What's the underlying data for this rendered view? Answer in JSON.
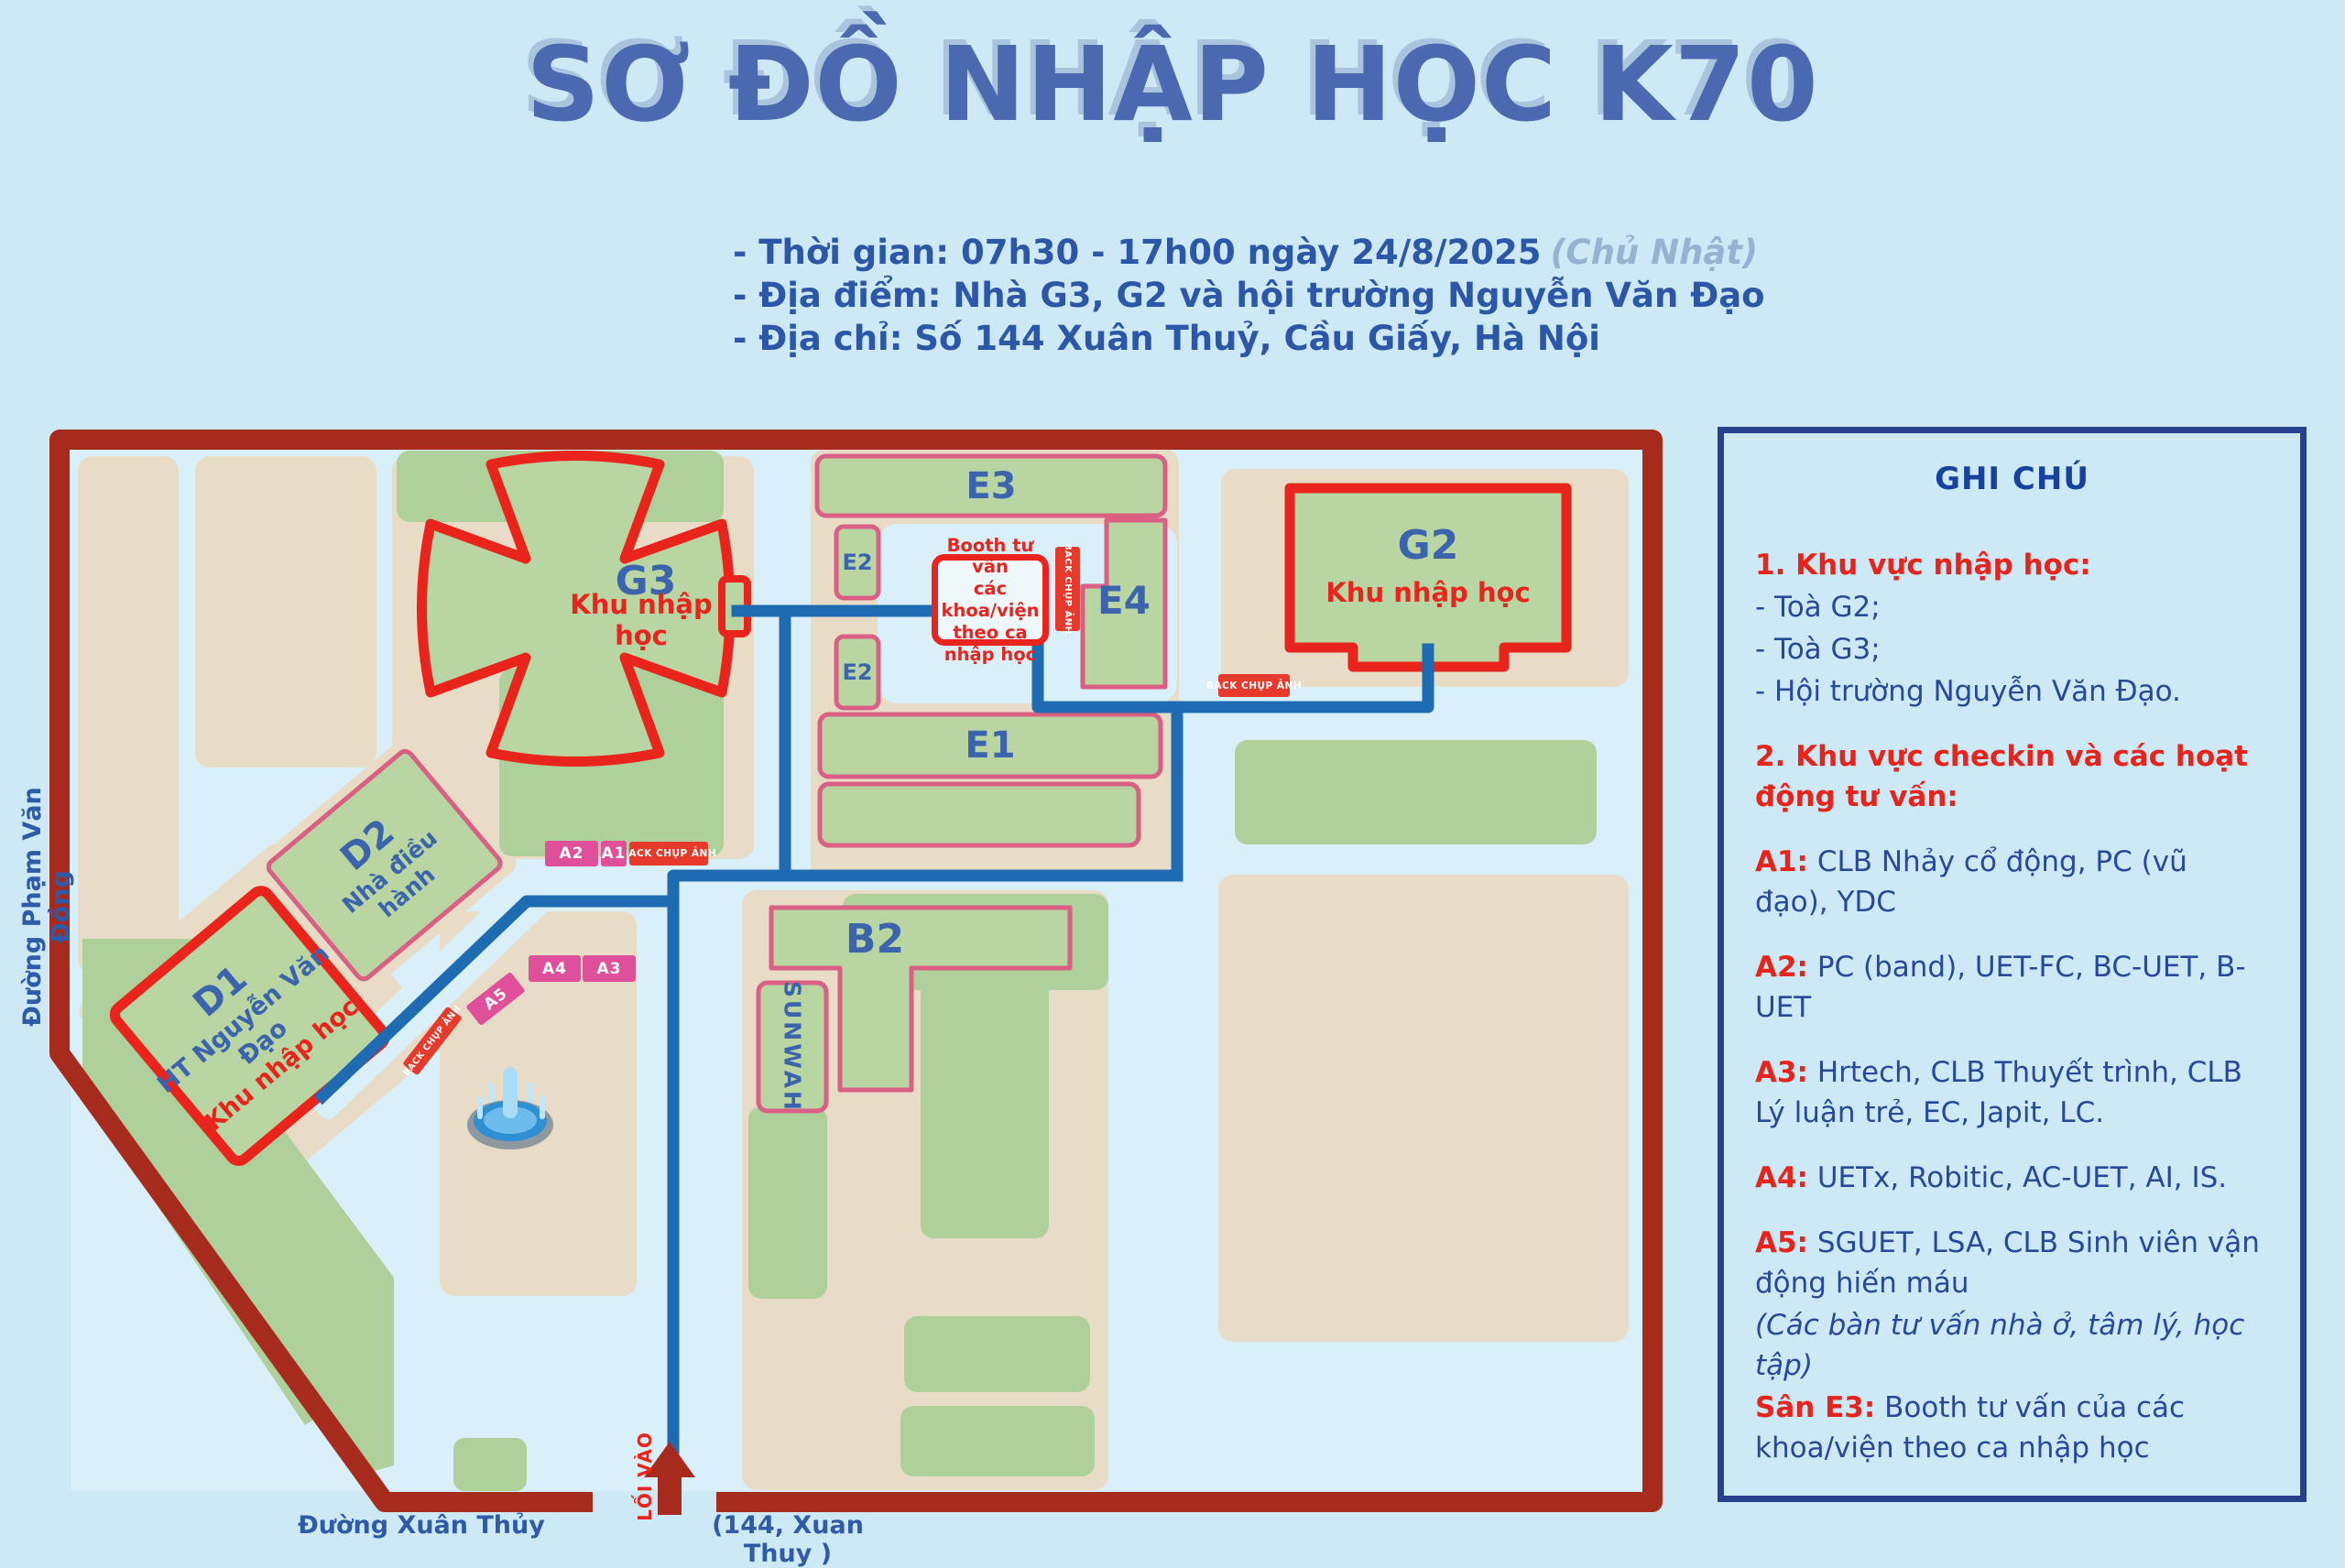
{
  "title": "SƠ ĐỒ NHẬP HỌC K70",
  "info_lines": [
    {
      "main": "- Thời gian: 07h30 - 17h00 ngày 24/8/2025",
      "note": "(Chủ Nhật)"
    },
    {
      "main": "- Địa điểm: Nhà G3, G2 và hội trường Nguyễn Văn Đạo",
      "note": ""
    },
    {
      "main": "- Địa chỉ: Số 144 Xuân Thuỷ, Cầu Giấy, Hà Nội",
      "note": ""
    }
  ],
  "map": {
    "streets": {
      "left": "Đường Phạm Văn Đồng",
      "bottom": "Đường Xuân Thủy",
      "address": "(144, Xuan Thuy )",
      "entrance": "LỐI VÀO"
    },
    "buildings": {
      "g3": {
        "name": "G3",
        "sub": "Khu nhập học"
      },
      "g2": {
        "name": "G2",
        "sub": "Khu nhập học"
      },
      "e3": {
        "name": "E3"
      },
      "e2a": {
        "name": "E2"
      },
      "e2b": {
        "name": "E2"
      },
      "e4": {
        "name": "E4"
      },
      "e1": {
        "name": "E1"
      },
      "b2": {
        "name": "B2"
      },
      "sunwah": {
        "name": "SUNWAH"
      },
      "d2": {
        "name": "D2",
        "sub": "Nhà điều hành"
      },
      "d1": {
        "name": "D1",
        "sub1": "HT Nguyễn Văn Đạo",
        "sub2": "Khu nhập học"
      }
    },
    "booth": {
      "lines": [
        "Booth tư vấn",
        "các khoa/viện",
        "theo ca",
        "nhập học"
      ]
    },
    "badges": {
      "a1": "A1",
      "a2": "A2",
      "a3": "A3",
      "a4": "A4",
      "a5": "A5",
      "back": "BACK CHỤP ẢNH"
    }
  },
  "legend": {
    "title": "GHI CHÚ",
    "section1": {
      "head": "1. Khu vực nhập học:",
      "items": [
        "- Toà G2;",
        "- Toà G3;",
        "- Hội trường Nguyễn Văn Đạo."
      ]
    },
    "section2": {
      "head": "2. Khu vực checkin và các hoạt động tư vấn:"
    },
    "entries": [
      {
        "key": "A1:",
        "text": " CLB Nhảy cổ động, PC (vũ đạo), YDC"
      },
      {
        "key": "A2:",
        "text": " PC (band), UET-FC, BC-UET, B-UET"
      },
      {
        "key": "A3:",
        "text": " Hrtech, CLB Thuyết trình, CLB Lý luận trẻ, EC, Japit, LC."
      },
      {
        "key": "A4:",
        "text": " UETx, Robitic, AC-UET, AI, IS."
      },
      {
        "key": "A5:",
        "text": " SGUET, LSA, CLB Sinh viên vận động hiến máu",
        "note": "(Các bàn tư vấn nhà ở, tâm lý, học tập)"
      },
      {
        "key": "Sân E3:",
        "text": " Booth tư vấn của các khoa/viện theo ca nhập học"
      }
    ]
  },
  "colors": {
    "background": "#cde9f6",
    "road": "#d9effa",
    "block_beige": "#e9dcc7",
    "lawn_green": "#aed09a",
    "building_green": "#b8d5a2",
    "highlight_red": "#e8241c",
    "building_pink_border": "#d95f84",
    "boundary_dark_red": "#a62b1c",
    "route_blue": "#1e6bb2",
    "label_blue": "#3b64ad",
    "title_blue": "#4a69b0",
    "legend_border_navy": "#27418f",
    "badge_pink": "#e0509a"
  }
}
